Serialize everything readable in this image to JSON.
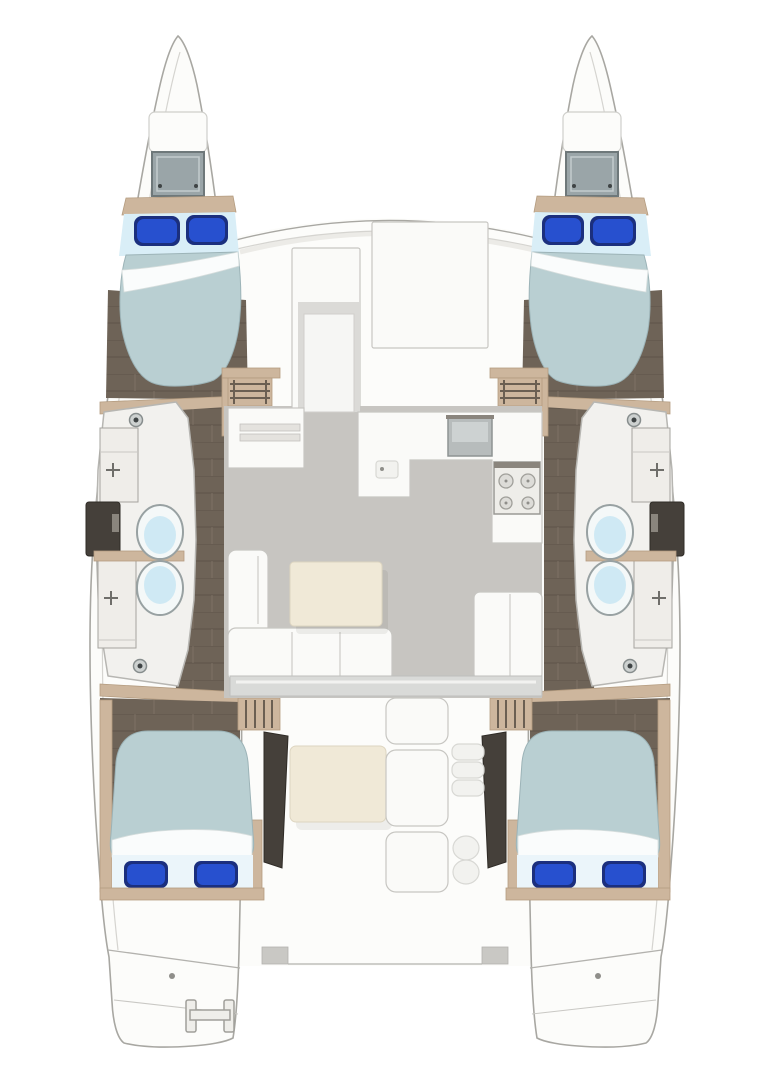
{
  "figure": {
    "type": "catamaran-floor-plan",
    "view": "overhead accommodation plan",
    "description": "Top-down floor plan of a sailing catamaran: four double cabins with blue pillows, four heads with toilets sinks and showers, central salon with galley sink and four-burner stove, L-sofa and tables, aft cockpit with bench and steps, twin bows and twin swim platforms with boarding ladder"
  },
  "colors": {
    "page_bg": "#ffffff",
    "hull_fill": "#fcfcfa",
    "hull_stroke": "#a8a7a2",
    "gunwale": "#d5d4d0",
    "deck_band": "#d9dad8",
    "wood": "#cdb69d",
    "wood_dark": "#b49c80",
    "sole": "#6e6357",
    "sole_line": "#5d5349",
    "sole_light": "#7d7164",
    "salon_floor": "#c7c5c1",
    "white_furniture": "#fafaf8",
    "furniture_stroke": "#c7c6c2",
    "table_cream": "#f0e9d7",
    "mattress": "#b9cfd2",
    "mattress_stroke": "#9cb3b7",
    "bed_head": "#d9eef7",
    "bed_foot": "#ebf5fa",
    "sheet": "#fafcfc",
    "pillow_blue": "#2750cf",
    "pillow_navy": "#1b2f7e",
    "hatch_fill": "#9aa5a8",
    "hatch_stroke": "#6e787a",
    "toilet_bowl": "#cfe9f4",
    "fixture_white": "#efede9",
    "dark_fixture": "#45403a",
    "sink_gray": "#b7bcbc",
    "bath_floor": "#f2f1ee",
    "bath_stroke": "#b7b6b2",
    "line_gray": "#b3b2ae"
  },
  "rooms": [
    {
      "id": "cabin-fwd-port",
      "label": "Forward cabin (port)",
      "berth": "double",
      "pillows": 2,
      "overhead_hatch": true
    },
    {
      "id": "cabin-fwd-stbd",
      "label": "Forward cabin (starboard)",
      "berth": "double",
      "pillows": 2,
      "overhead_hatch": true
    },
    {
      "id": "head-port",
      "label": "Heads (port hull)",
      "toilets": 2,
      "sinks": 2,
      "shower": true
    },
    {
      "id": "head-stbd",
      "label": "Heads (starboard hull)",
      "toilets": 2,
      "sinks": 2,
      "shower": true
    },
    {
      "id": "salon",
      "label": "Salon & galley",
      "features": [
        "galley sink",
        "4-burner stove",
        "L-counter",
        "sideboard with drawers",
        "nav seat",
        "L-sofa",
        "coffee table",
        "aft cabinet"
      ]
    },
    {
      "id": "cockpit",
      "label": "Aft cockpit",
      "features": [
        "dining table",
        "bench seating",
        "side steps",
        "sliding-door sill"
      ]
    },
    {
      "id": "cabin-aft-port",
      "label": "Aft cabin (port)",
      "berth": "double",
      "pillows": 2
    },
    {
      "id": "cabin-aft-stbd",
      "label": "Aft cabin (starboard)",
      "berth": "double",
      "pillows": 2
    },
    {
      "id": "transom",
      "label": "Twin swim platforms",
      "features": [
        "boarding ladder (port)",
        "transom line"
      ]
    }
  ],
  "totals": {
    "cabins": 4,
    "heads": 4,
    "berths": 4
  }
}
